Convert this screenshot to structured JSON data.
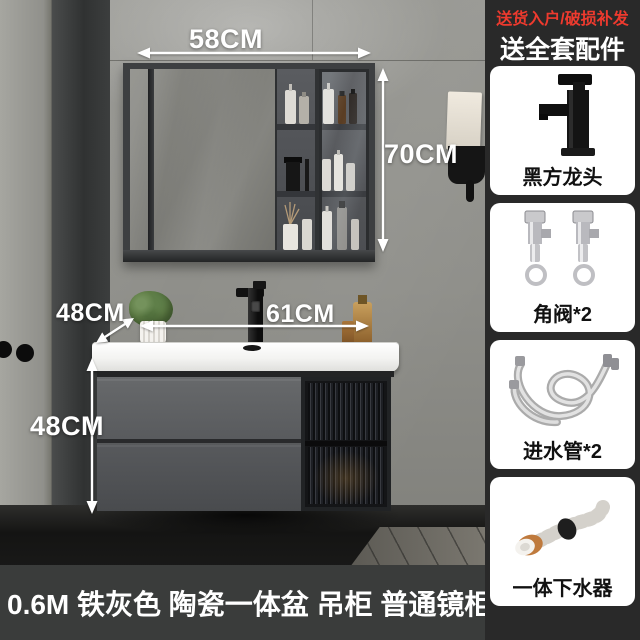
{
  "product_image": {
    "dimensions": {
      "mirror_width": "58CM",
      "mirror_height": "70CM",
      "counter_depth": "48CM",
      "basin_width": "61CM",
      "cabinet_height": "48CM"
    },
    "caption": "0.6M 铁灰色 陶瓷一体盆 吊柜 普通镜柜"
  },
  "sidebar": {
    "header_line1": "送货入户/破损补发",
    "header_line2": "送全套配件",
    "items": [
      {
        "label": "黑方龙头",
        "icon": "black-faucet-icon"
      },
      {
        "label": "角阀*2",
        "icon": "angle-valves-icon"
      },
      {
        "label": "进水管*2",
        "icon": "inlet-hoses-icon"
      },
      {
        "label": "一体下水器",
        "icon": "drain-pipe-icon"
      }
    ]
  },
  "colors": {
    "accent_red": "#ee3a2e",
    "caption_bar": "#3a3c3b",
    "sidebar_bg": "#292929",
    "cabinet_gray": "#5d5f61",
    "basin_white": "#f4f3f1",
    "annotation_white": "#ffffff"
  }
}
